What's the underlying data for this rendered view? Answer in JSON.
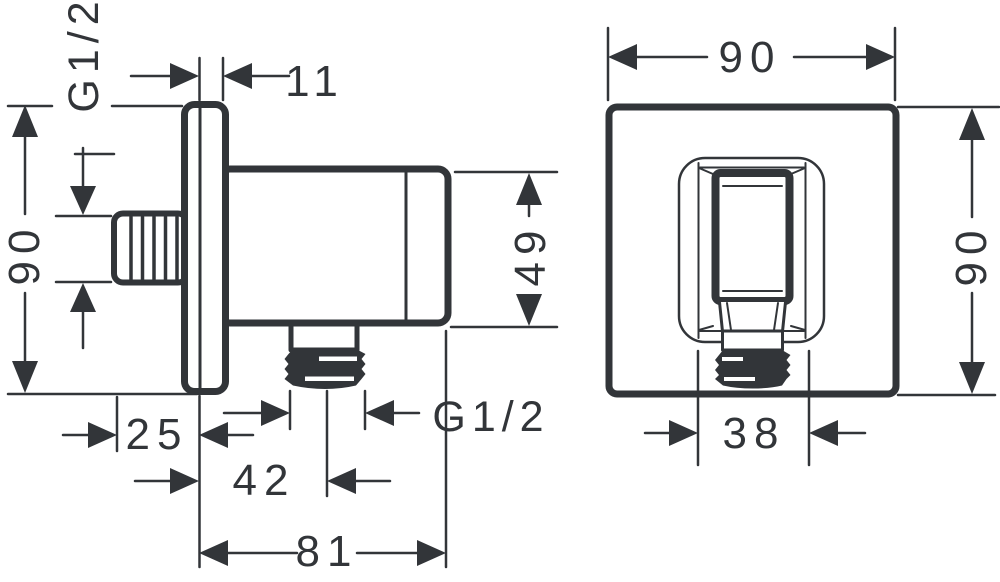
{
  "drawing": {
    "kind": "technical dimension drawing",
    "colors": {
      "line": "#323539",
      "background": "#ffffff"
    }
  },
  "side_view": {
    "labels": {
      "plate_offset": "11",
      "inlet_thread": "G1/2",
      "overall_height": "90",
      "holder_height": "49",
      "outlet_thread": "G1/2",
      "inlet_depth": "25",
      "outlet_axis_depth": "42",
      "overall_depth": "81"
    }
  },
  "front_view": {
    "labels": {
      "overall_width": "90",
      "overall_height": "90",
      "outlet_width": "38"
    }
  }
}
